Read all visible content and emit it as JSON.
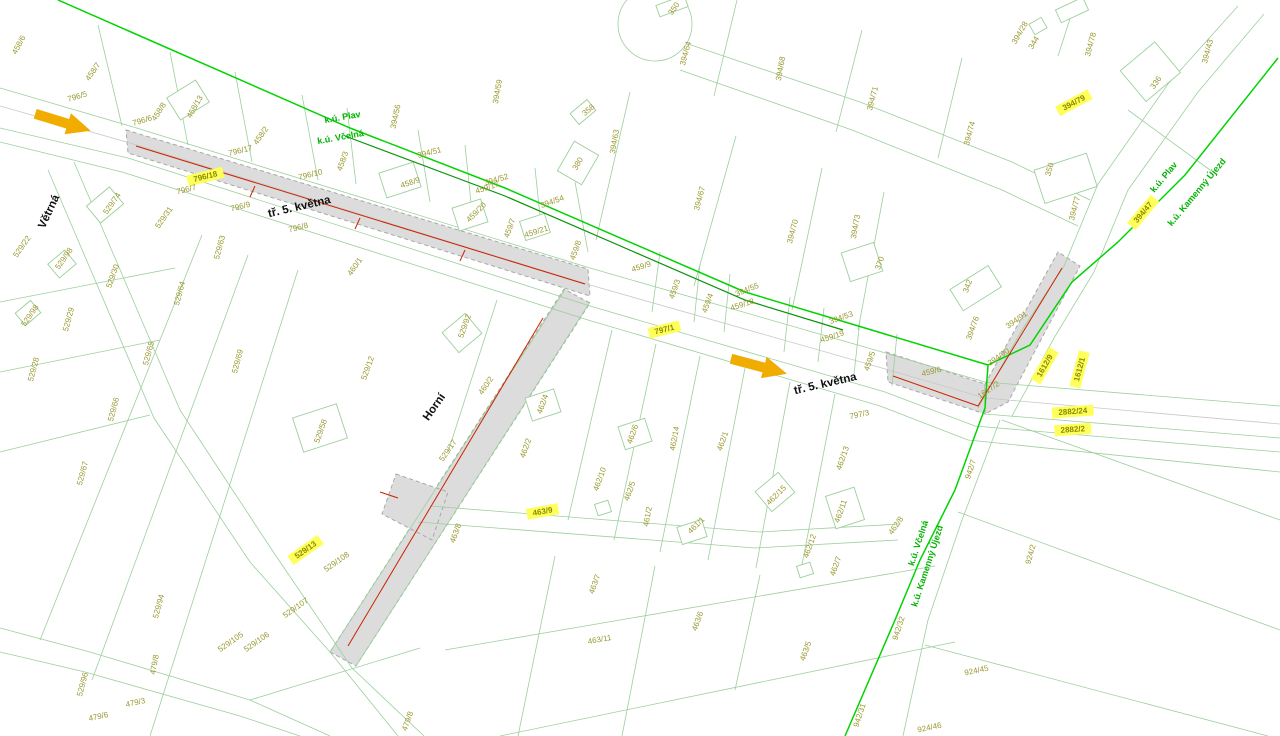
{
  "title_block": {
    "scale": "1:1000",
    "title_line1": "KATASTRÁLNÍ",
    "title_line2": "SITUAČNÍ VÝKRES",
    "drawing_number": "C.2"
  },
  "legend": {
    "items": [
      {
        "id": "cadastral-area-boundary",
        "label": "HRANICE KATASTRÁL. ÚZEMÍ",
        "swatch": "line",
        "color": "#00d400",
        "text_color": "#00cc00"
      },
      {
        "id": "main-cadastre-boundary",
        "label": "HRANICE KATASTRU HLAVNÍ",
        "swatch": "line",
        "color": "#008000",
        "text_color": "#007a00"
      },
      {
        "id": "inner-cadastre-boundary",
        "label": "HRANICE KATASTRU VNITŘNÍ",
        "swatch": "line",
        "color": "#b5b5b5",
        "text_color": "#a3a3a3"
      },
      {
        "id": "site-access",
        "label": "PŘÍJEZD NA STAVENIŠTĚ",
        "swatch": "arrow-left",
        "color": "#f0ad00",
        "text_color": "#f0c011"
      },
      {
        "id": "site-boundary",
        "label": "HRANICE STAVENIŠTĚ",
        "swatch": "hatch",
        "color": "#dcdcdc",
        "text_color": "#000000"
      },
      {
        "id": "affected-parcel",
        "label": "DOTČENÁ PARCELA",
        "swatch": "chip",
        "sample": "000/0",
        "color": "#ffff5c",
        "text_color": "#000000"
      },
      {
        "id": "proposed-objects",
        "label": "NAVRHOVANÉ OBJEKTY",
        "swatch": "line",
        "color": "#cc2200",
        "text_color": "#000000"
      }
    ]
  },
  "colors": {
    "boundary_bright_green": "#00d400",
    "boundary_dark_green": "#089408",
    "boundary_gray": "#b5b5b5",
    "arrow_orange": "#f0ad00",
    "highlight_yellow": "#ffff5c",
    "proposed_red": "#cc2200",
    "parcel_label_olive": "#98982f",
    "parcel_line_green": "#9ccf9c"
  },
  "map": {
    "street_labels": [
      {
        "t": "Větrná",
        "x": 52,
        "y": 213,
        "r": -65
      },
      {
        "t": "tř. 5. května",
        "x": 300,
        "y": 210,
        "r": -13
      },
      {
        "t": "tř. 5. května",
        "x": 826,
        "y": 387,
        "r": -13
      },
      {
        "t": "Horní",
        "x": 437,
        "y": 409,
        "r": -55
      }
    ],
    "ku_labels": [
      {
        "t": "k.ú. Plav",
        "x": 343,
        "y": 120,
        "r": -10
      },
      {
        "t": "k.ú. Včelná",
        "x": 341,
        "y": 140,
        "r": -10
      },
      {
        "t": "k.ú. Plav",
        "x": 1166,
        "y": 179,
        "r": -50
      },
      {
        "t": "k.ú. Kamenný Újezd",
        "x": 1199,
        "y": 194,
        "r": -50
      },
      {
        "t": "k.ú. Včelná",
        "x": 921,
        "y": 544,
        "r": -72
      },
      {
        "t": "k.ú. Kamenný Újezd",
        "x": 930,
        "y": 567,
        "r": -72
      }
    ],
    "parcel_labels": [
      {
        "t": "458/6",
        "x": 21,
        "y": 46,
        "r": -62
      },
      {
        "t": "458/7",
        "x": 95,
        "y": 73,
        "r": -55
      },
      {
        "t": "796/5",
        "x": 78,
        "y": 99,
        "r": -17
      },
      {
        "t": "458/8",
        "x": 161,
        "y": 113,
        "r": -57
      },
      {
        "t": "458/13",
        "x": 197,
        "y": 108,
        "r": -60
      },
      {
        "t": "796/6",
        "x": 143,
        "y": 123,
        "r": -17
      },
      {
        "t": "458/2",
        "x": 263,
        "y": 137,
        "r": -55
      },
      {
        "t": "796/17",
        "x": 241,
        "y": 153,
        "r": -14
      },
      {
        "t": "796/18",
        "x": 206,
        "y": 179,
        "r": -14,
        "h": 1
      },
      {
        "t": "796/7",
        "x": 187,
        "y": 192,
        "r": -14
      },
      {
        "t": "796/10",
        "x": 311,
        "y": 177,
        "r": -14
      },
      {
        "t": "796/9",
        "x": 241,
        "y": 209,
        "r": -14
      },
      {
        "t": "796/8",
        "x": 299,
        "y": 230,
        "r": -14
      },
      {
        "t": "529/74",
        "x": 114,
        "y": 205,
        "r": -55
      },
      {
        "t": "529/31",
        "x": 166,
        "y": 219,
        "r": -55
      },
      {
        "t": "529/22",
        "x": 24,
        "y": 248,
        "r": -55
      },
      {
        "t": "529/98",
        "x": 66,
        "y": 260,
        "r": -55
      },
      {
        "t": "529/98",
        "x": 32,
        "y": 317,
        "r": -55
      },
      {
        "t": "529/30",
        "x": 115,
        "y": 277,
        "r": -70
      },
      {
        "t": "529/63",
        "x": 222,
        "y": 248,
        "r": -75
      },
      {
        "t": "529/64",
        "x": 182,
        "y": 294,
        "r": -75
      },
      {
        "t": "529/29",
        "x": 71,
        "y": 320,
        "r": -75
      },
      {
        "t": "529/28",
        "x": 36,
        "y": 370,
        "r": -75
      },
      {
        "t": "529/65",
        "x": 151,
        "y": 354,
        "r": -75
      },
      {
        "t": "529/66",
        "x": 116,
        "y": 410,
        "r": -75
      },
      {
        "t": "529/69",
        "x": 240,
        "y": 362,
        "r": -75
      },
      {
        "t": "529/67",
        "x": 85,
        "y": 474,
        "r": -75
      },
      {
        "t": "529/94",
        "x": 161,
        "y": 607,
        "r": -75
      },
      {
        "t": "529/96",
        "x": 85,
        "y": 685,
        "r": -75
      },
      {
        "t": "479/8",
        "x": 157,
        "y": 665,
        "r": -80
      },
      {
        "t": "479/3",
        "x": 136,
        "y": 705,
        "r": -12
      },
      {
        "t": "479/6",
        "x": 99,
        "y": 719,
        "r": -12
      },
      {
        "t": "529/13",
        "x": 307,
        "y": 552,
        "r": -35,
        "h": 1
      },
      {
        "t": "529/108",
        "x": 338,
        "y": 564,
        "r": -35
      },
      {
        "t": "529/107",
        "x": 297,
        "y": 610,
        "r": -35
      },
      {
        "t": "529/106",
        "x": 258,
        "y": 644,
        "r": -35
      },
      {
        "t": "529/105",
        "x": 232,
        "y": 644,
        "r": -35
      },
      {
        "t": "479/8",
        "x": 410,
        "y": 722,
        "r": -70
      },
      {
        "t": "529/12",
        "x": 370,
        "y": 369,
        "r": -70
      },
      {
        "t": "529/92",
        "x": 467,
        "y": 327,
        "r": -70
      },
      {
        "t": "529/58",
        "x": 323,
        "y": 432,
        "r": -70
      },
      {
        "t": "529/17",
        "x": 450,
        "y": 452,
        "r": -55
      },
      {
        "t": "460/1",
        "x": 357,
        "y": 268,
        "r": -55
      },
      {
        "t": "460/2",
        "x": 488,
        "y": 387,
        "r": -55
      },
      {
        "t": "394/56",
        "x": 398,
        "y": 117,
        "r": -78
      },
      {
        "t": "394/59",
        "x": 500,
        "y": 92,
        "r": -80
      },
      {
        "t": "394/51",
        "x": 430,
        "y": 155,
        "r": -14
      },
      {
        "t": "394/52",
        "x": 497,
        "y": 182,
        "r": -16
      },
      {
        "t": "394/54",
        "x": 553,
        "y": 204,
        "r": -20
      },
      {
        "t": "394/55",
        "x": 748,
        "y": 292,
        "r": -22
      },
      {
        "t": "394/53",
        "x": 842,
        "y": 320,
        "r": -20
      },
      {
        "t": "358",
        "x": 590,
        "y": 112,
        "r": -40
      },
      {
        "t": "394/63",
        "x": 617,
        "y": 142,
        "r": -80
      },
      {
        "t": "380",
        "x": 580,
        "y": 165,
        "r": -60
      },
      {
        "t": "458/3",
        "x": 345,
        "y": 162,
        "r": -70
      },
      {
        "t": "458/9",
        "x": 411,
        "y": 185,
        "r": -18
      },
      {
        "t": "459/17",
        "x": 488,
        "y": 190,
        "r": -18
      },
      {
        "t": "459/20",
        "x": 478,
        "y": 214,
        "r": -45
      },
      {
        "t": "459/7",
        "x": 512,
        "y": 229,
        "r": -70
      },
      {
        "t": "459/21",
        "x": 537,
        "y": 234,
        "r": -18
      },
      {
        "t": "459/8",
        "x": 578,
        "y": 251,
        "r": -70
      },
      {
        "t": "459/9",
        "x": 642,
        "y": 269,
        "r": -18
      },
      {
        "t": "459/3",
        "x": 677,
        "y": 290,
        "r": -70
      },
      {
        "t": "459/4",
        "x": 710,
        "y": 304,
        "r": -70
      },
      {
        "t": "459/18",
        "x": 743,
        "y": 307,
        "r": -18
      },
      {
        "t": "459/19",
        "x": 833,
        "y": 339,
        "r": -18
      },
      {
        "t": "459/5",
        "x": 872,
        "y": 362,
        "r": -70
      },
      {
        "t": "370",
        "x": 882,
        "y": 264,
        "r": -70
      },
      {
        "t": "350",
        "x": 676,
        "y": 10,
        "r": -55
      },
      {
        "t": "394/64",
        "x": 688,
        "y": 54,
        "r": -75
      },
      {
        "t": "394/68",
        "x": 783,
        "y": 69,
        "r": -80
      },
      {
        "t": "394/71",
        "x": 875,
        "y": 99,
        "r": -75
      },
      {
        "t": "394/67",
        "x": 702,
        "y": 199,
        "r": -75
      },
      {
        "t": "394/70",
        "x": 795,
        "y": 232,
        "r": -75
      },
      {
        "t": "394/73",
        "x": 858,
        "y": 227,
        "r": -80
      },
      {
        "t": "394/28",
        "x": 1022,
        "y": 34,
        "r": -60
      },
      {
        "t": "344",
        "x": 1036,
        "y": 44,
        "r": -60
      },
      {
        "t": "394/78",
        "x": 1093,
        "y": 45,
        "r": -75
      },
      {
        "t": "394/43",
        "x": 1210,
        "y": 52,
        "r": -75
      },
      {
        "t": "336",
        "x": 1158,
        "y": 84,
        "r": -55
      },
      {
        "t": "394/74",
        "x": 972,
        "y": 134,
        "r": -75
      },
      {
        "t": "350",
        "x": 1052,
        "y": 170,
        "r": -75
      },
      {
        "t": "394/77",
        "x": 1077,
        "y": 209,
        "r": -75
      },
      {
        "t": "394/79",
        "x": 1075,
        "y": 105,
        "r": -28,
        "h": 1
      },
      {
        "t": "394/47",
        "x": 1145,
        "y": 214,
        "r": -50,
        "h": 1
      },
      {
        "t": "342",
        "x": 970,
        "y": 287,
        "r": -70
      },
      {
        "t": "394/76",
        "x": 975,
        "y": 329,
        "r": -70
      },
      {
        "t": "394/91",
        "x": 1018,
        "y": 322,
        "r": -35
      },
      {
        "t": "394/90",
        "x": 1000,
        "y": 359,
        "r": -35
      },
      {
        "t": "1617/2",
        "x": 990,
        "y": 392,
        "r": -35
      },
      {
        "t": "459/6",
        "x": 932,
        "y": 374,
        "r": -14
      },
      {
        "t": "1612/9",
        "x": 1047,
        "y": 367,
        "r": -60,
        "h": 1
      },
      {
        "t": "1612/1",
        "x": 1082,
        "y": 370,
        "r": -75,
        "h": 1
      },
      {
        "t": "2882/24",
        "x": 1073,
        "y": 414,
        "r": -4,
        "h": 1
      },
      {
        "t": "2882/2",
        "x": 1073,
        "y": 432,
        "r": -4,
        "h": 1
      },
      {
        "t": "797/1",
        "x": 665,
        "y": 332,
        "r": -14,
        "h": 1
      },
      {
        "t": "797/3",
        "x": 860,
        "y": 417,
        "r": -12
      },
      {
        "t": "462/4",
        "x": 545,
        "y": 405,
        "r": -70
      },
      {
        "t": "462/2",
        "x": 528,
        "y": 449,
        "r": -70
      },
      {
        "t": "462/6",
        "x": 635,
        "y": 435,
        "r": -70
      },
      {
        "t": "462/14",
        "x": 677,
        "y": 439,
        "r": -80
      },
      {
        "t": "462/1",
        "x": 725,
        "y": 442,
        "r": -70
      },
      {
        "t": "462/10",
        "x": 602,
        "y": 480,
        "r": -70
      },
      {
        "t": "462/5",
        "x": 632,
        "y": 492,
        "r": -70
      },
      {
        "t": "461/2",
        "x": 650,
        "y": 517,
        "r": -80
      },
      {
        "t": "461/1",
        "x": 698,
        "y": 527,
        "r": -45
      },
      {
        "t": "463/8",
        "x": 458,
        "y": 534,
        "r": -70
      },
      {
        "t": "463/9",
        "x": 543,
        "y": 514,
        "r": -10,
        "h": 1
      },
      {
        "t": "462/13",
        "x": 845,
        "y": 459,
        "r": -70
      },
      {
        "t": "462/15",
        "x": 778,
        "y": 497,
        "r": -45
      },
      {
        "t": "462/11",
        "x": 843,
        "y": 512,
        "r": -70
      },
      {
        "t": "462/12",
        "x": 812,
        "y": 547,
        "r": -70
      },
      {
        "t": "462/7",
        "x": 838,
        "y": 567,
        "r": -70
      },
      {
        "t": "462/8",
        "x": 898,
        "y": 527,
        "r": -55
      },
      {
        "t": "463/7",
        "x": 597,
        "y": 585,
        "r": -70
      },
      {
        "t": "463/6",
        "x": 700,
        "y": 622,
        "r": -70
      },
      {
        "t": "463/11",
        "x": 600,
        "y": 642,
        "r": -10
      },
      {
        "t": "463/5",
        "x": 808,
        "y": 652,
        "r": -70
      },
      {
        "t": "942/7",
        "x": 973,
        "y": 470,
        "r": -72
      },
      {
        "t": "942/32",
        "x": 901,
        "y": 629,
        "r": -72
      },
      {
        "t": "942/31",
        "x": 862,
        "y": 716,
        "r": -72
      },
      {
        "t": "924/2",
        "x": 1033,
        "y": 555,
        "r": -75
      },
      {
        "t": "924/45",
        "x": 977,
        "y": 673,
        "r": -12
      },
      {
        "t": "924/46",
        "x": 930,
        "y": 730,
        "r": -12
      }
    ]
  }
}
